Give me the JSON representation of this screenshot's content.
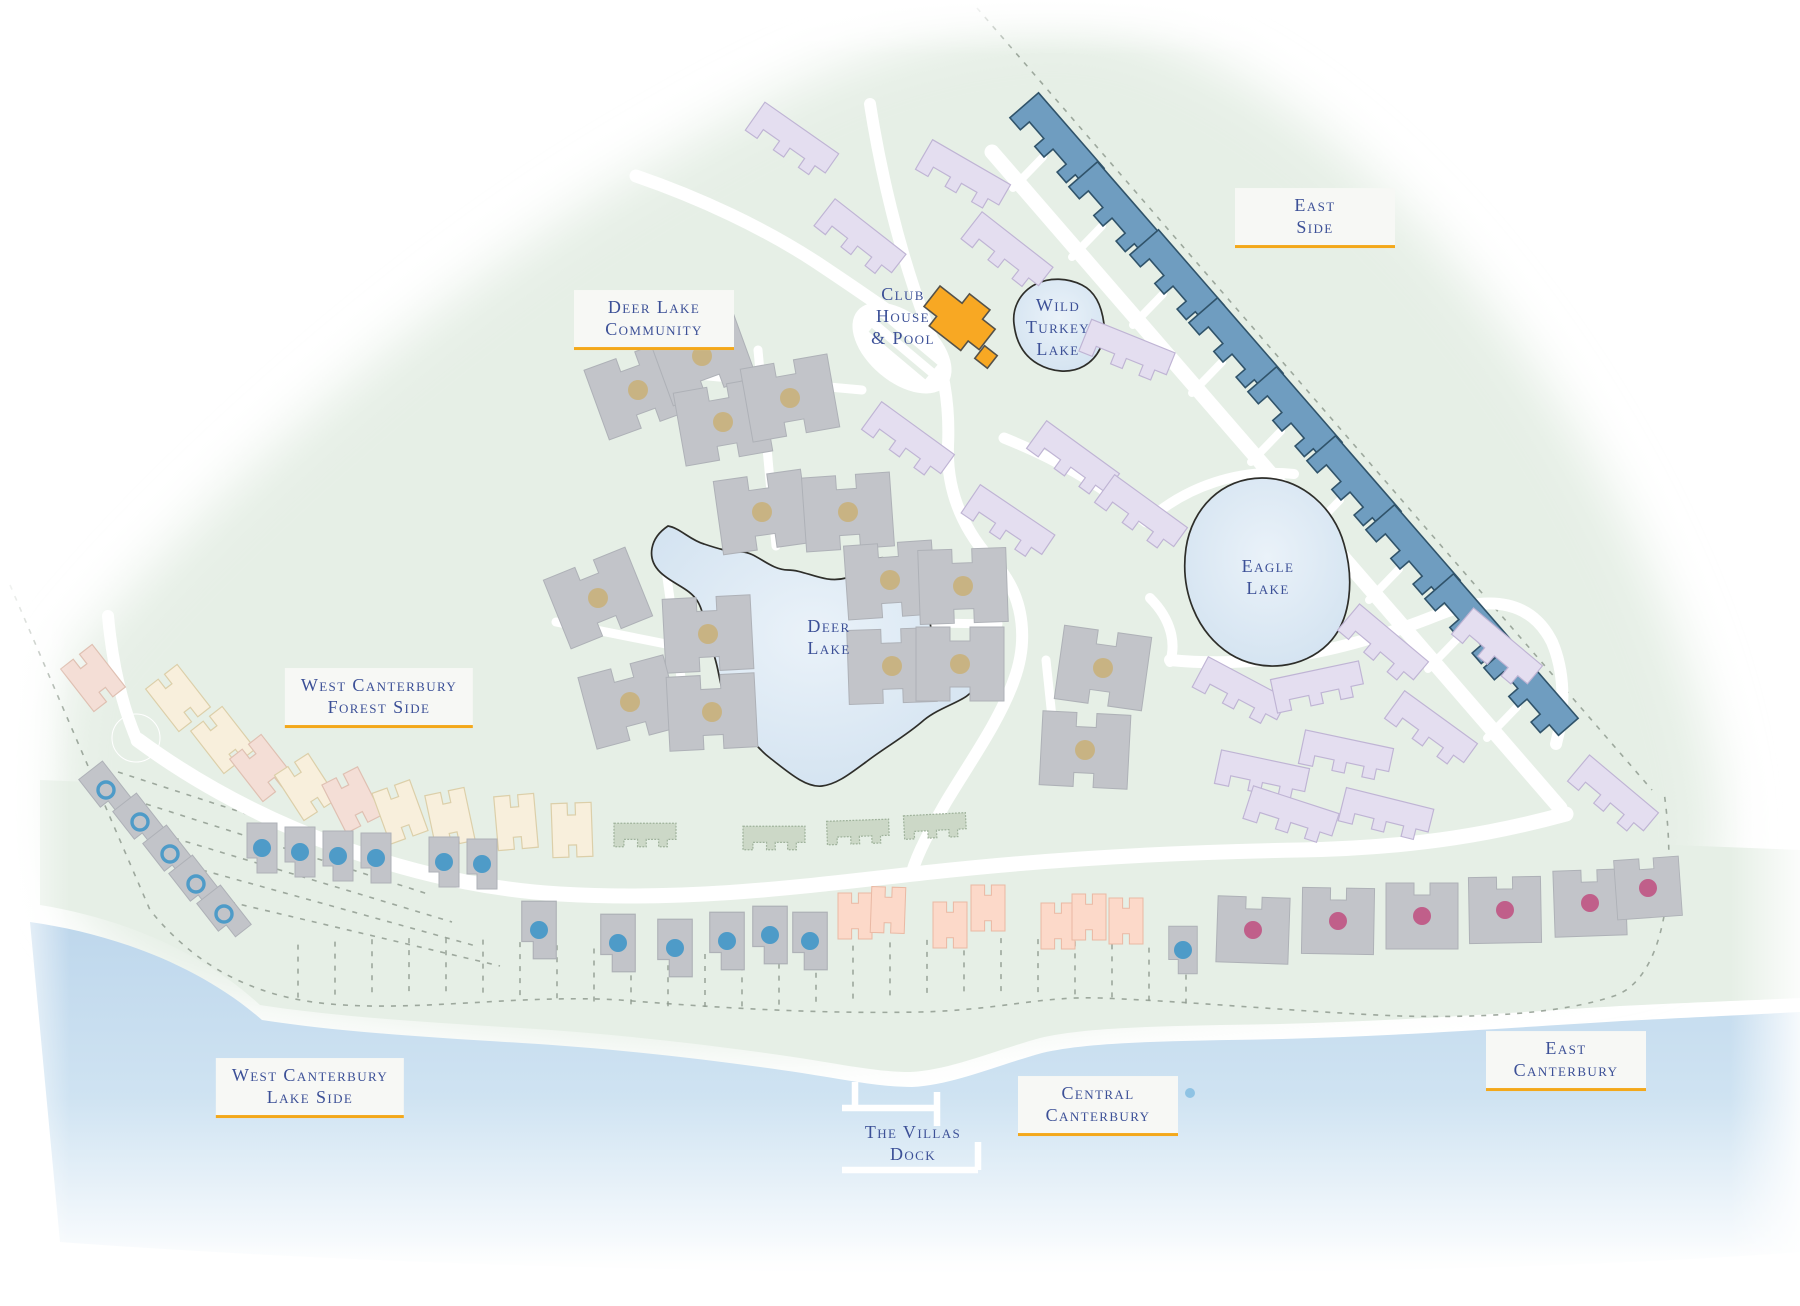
{
  "region_labels": {
    "east_side": {
      "line1": "East",
      "line2": "Side"
    },
    "deer_lake_community": {
      "line1": "Deer Lake",
      "line2": "Community"
    },
    "west_canterbury_forest_side": {
      "line1": "West Canterbury",
      "line2": "Forest Side"
    },
    "west_canterbury_lake_side": {
      "line1": "West Canterbury",
      "line2": "Lake Side"
    },
    "central_canterbury": {
      "line1": "Central",
      "line2": "Canterbury"
    },
    "east_canterbury": {
      "line1": "East",
      "line2": "Canterbury"
    }
  },
  "place_labels": {
    "club_house_pool": {
      "line1": "Club",
      "line2": "House",
      "line3": "& Pool"
    },
    "wild_turkey_lake": {
      "line1": "Wild",
      "line2": "Turkey",
      "line3": "Lake"
    },
    "eagle_lake": {
      "line1": "Eagle",
      "line2": "Lake"
    },
    "deer_lake": {
      "line1": "Deer",
      "line2": "Lake"
    },
    "the_villas_dock": {
      "line1": "The Villas",
      "line2": "Dock"
    }
  },
  "colors": {
    "land": "#e6efe6",
    "water_top": "#bed7ec",
    "water_mid": "#cfe3f2",
    "road": "#ffffff",
    "lake_outline": "#2e2e2a",
    "lake_light": "#eaf2f9",
    "lake_deep": "#cfe0ef",
    "building_blue": "#6f9dc0",
    "building_blue_outline": "#30536a",
    "building_lavender": "#e4def0",
    "building_lavender_outline": "#bfb4d4",
    "building_gray": "#c2c4c9",
    "building_gray_outline": "#aeb1b7",
    "building_cream": "#f8efdc",
    "building_cream_outline": "#dccfa9",
    "building_pink": "#f4ded6",
    "building_pink_outline": "#dfc0b2",
    "building_salmon": "#fcd9c9",
    "building_salmon_outline": "#eab9a4",
    "building_sage": "#ccd8c7",
    "building_sage_outline": "#9fb29b",
    "clubhouse_orange": "#f8a823",
    "dot_tan": "#c8b383",
    "dot_blue": "#4e9bc8",
    "dot_rose": "#c05f8a",
    "water_marker_blue": "#8fc3e4",
    "label_text": "#3c5097",
    "label_underline": "#f3a81b",
    "label_bg": "#f7f8f5",
    "boundary_dash": "#8f9b8f"
  }
}
